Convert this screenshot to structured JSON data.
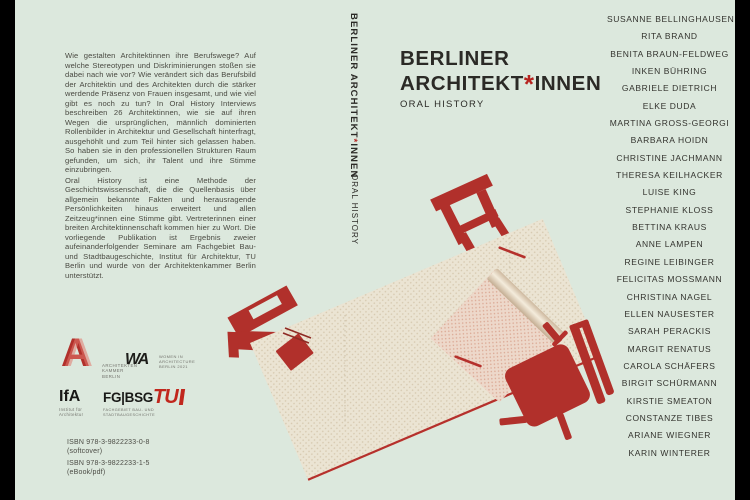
{
  "colors": {
    "background": "#dce8dd",
    "accent_red": "#b1302b",
    "asterisk_red": "#b6231f",
    "table_beige": "#ebe4d3",
    "text_dark": "#2b2a26"
  },
  "back_cover": {
    "blurb_paragraph_1": "Wie gestalten Architektinnen ihre Berufswege? Auf welche Stereotypen und Diskriminierungen stoßen sie dabei nach wie vor? Wie verändert sich das Berufsbild der Architektin und des Architekten durch die stärker werdende Präsenz von Frauen insgesamt, und wie viel gibt es noch zu tun? In Oral History Interviews beschreiben 26 Architektinnen, wie sie auf ihren Wegen die ursprünglichen, männlich dominierten Rollenbilder in Architektur und Gesellschaft hinterfragt, ausgehöhlt und zum Teil hinter sich gelassen haben. So haben sie in den professionellen Strukturen Raum gefunden, um sich, ihr Talent und ihre Stimme einzubringen.",
    "blurb_paragraph_2": "Oral History ist eine Methode der Geschichtswissenschaft, die die Quellenbasis über allgemein bekannte Fakten und herausragende Persönlichkeiten hinaus erweitert und allen Zeitzeug*innen eine Stimme gibt. Vertreterinnen einer breiten Architektinnenschaft kommen hier zu Wort. Die vorliegende Publikation ist Ergebnis zweier aufeinanderfolgender Seminare am Fachgebiet Bau- und Stadtbaugeschichte, Institut für Architektur, TU Berlin und wurde von der Architektenkammer Berlin unterstützt.",
    "logos": {
      "architektenkammer": {
        "mark": "A",
        "caption": [
          "ARCHITEKTEN",
          "KAMMER",
          "BERLIN"
        ]
      },
      "wia": {
        "mark": "WA",
        "caption": [
          "WOMEN IN",
          "ARCHITECTURE",
          "BERLIN 2021"
        ]
      },
      "ifa": {
        "mark": "IfA",
        "caption": [
          "Institut für",
          "Architektur"
        ]
      },
      "fgbsg": {
        "mark": "FG|BSG",
        "caption": [
          "FACHGEBIET BAU- UND",
          "STADTBAUGESCHICHTE"
        ]
      },
      "tu": {
        "mark": "TU"
      }
    },
    "isbn": {
      "line1": "ISBN 978-3-9822233-0-8",
      "line2": "(softcover)",
      "line3": "ISBN 978-3-9822233-1-5",
      "line4": "(eBook/pdf)"
    }
  },
  "spine": {
    "title_pre": "BERLINER ARCHITEKT",
    "asterisk": "*",
    "title_post": "INNEN",
    "subtitle": "ORAL HISTORY"
  },
  "front_cover": {
    "title_line1": "BERLINER",
    "title_line2_pre": "ARCHITEKT",
    "asterisk": "*",
    "title_line2_post": "INNEN",
    "subtitle": "ORAL HISTORY",
    "contributors": [
      "SUSANNE BELLINGHAUSEN",
      "RITA BRAND",
      "BENITA BRAUN-FELDWEG",
      "INKEN BÜHRING",
      "GABRIELE DIETRICH",
      "ELKE DUDA",
      "MARTINA GROSS-GEORGI",
      "BARBARA HOIDN",
      "CHRISTINE JACHMANN",
      "THERESA KEILHACKER",
      "LUISE KING",
      "STEPHANIE KLOSS",
      "BETTINA KRAUS",
      "ANNE LAMPEN",
      "REGINE LEIBINGER",
      "FELICITAS MOSSMANN",
      "CHRISTINA NAGEL",
      "ELLEN NAUSESTER",
      "SARAH PERACKIS",
      "MARGIT RENATUS",
      "CAROLA SCHÄFERS",
      "BIRGIT SCHÜRMANN",
      "KIRSTIE SMEATON",
      "CONSTANZE TIBES",
      "ARIANE WIEGNER",
      "KARIN WINTERER"
    ]
  }
}
